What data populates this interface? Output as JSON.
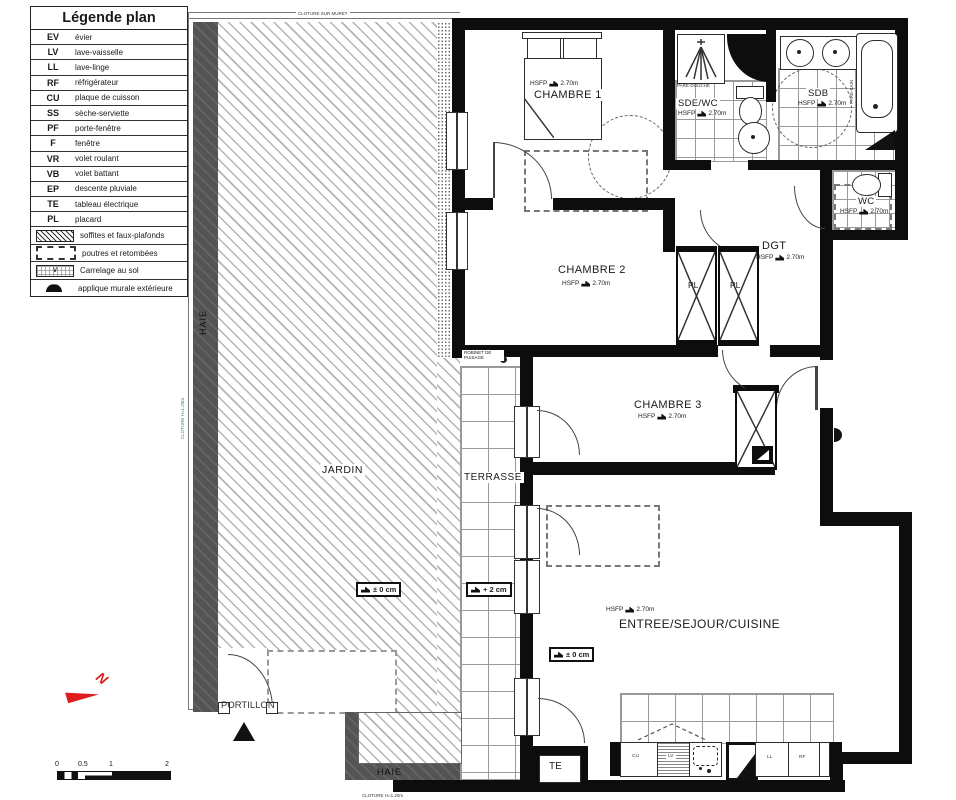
{
  "legend": {
    "title": "Légende plan",
    "items": [
      {
        "abbr": "EV",
        "label": "évier"
      },
      {
        "abbr": "LV",
        "label": "lave-vaisselle"
      },
      {
        "abbr": "LL",
        "label": "lave-linge"
      },
      {
        "abbr": "RF",
        "label": "réfrigérateur"
      },
      {
        "abbr": "CU",
        "label": "plaque de cuisson"
      },
      {
        "abbr": "SS",
        "label": "sèche-serviette"
      },
      {
        "abbr": "PF",
        "label": "porte-fenêtre"
      },
      {
        "abbr": "F",
        "label": "fenêtre"
      },
      {
        "abbr": "VR",
        "label": "volet roulant"
      },
      {
        "abbr": "VB",
        "label": "volet battant"
      },
      {
        "abbr": "EP",
        "label": "descente pluviale"
      },
      {
        "abbr": "TE",
        "label": "tableau électrique"
      },
      {
        "abbr": "PL",
        "label": "placard"
      }
    ],
    "symbols": [
      {
        "label": "soffites et faux-plafonds"
      },
      {
        "label": "poutres et retombées"
      },
      {
        "label": "Carrelage au sol"
      },
      {
        "label": "applique murale extérieure"
      }
    ]
  },
  "site": {
    "cloture_top": "CLOTURE SUR MURET",
    "cloture_left": "CLOTURE H=1.20m",
    "cloture_bottom": "CLOTURE H=1.20m",
    "haie": "HAIE",
    "jardin": "JARDIN",
    "terrasse": "TERRASSE",
    "portillon": "PORTILLON",
    "robinet": "ROBINET DE PUISAGE"
  },
  "rooms": {
    "chambre1": {
      "name": "CHAMBRE 1",
      "hsfp": "HSFP",
      "h": "2.70m"
    },
    "chambre2": {
      "name": "CHAMBRE 2",
      "hsfp": "HSFP",
      "h": "2.70m"
    },
    "chambre3": {
      "name": "CHAMBRE 3",
      "hsfp": "HSFP",
      "h": "2.70m"
    },
    "sdewc": {
      "name": "SDE/WC",
      "hsfp": "HSFP",
      "h": "2.70m"
    },
    "sdb": {
      "name": "SDB",
      "hsfp": "HSFP",
      "h": "2.70m"
    },
    "wc": {
      "name": "WC",
      "hsfp": "HSFP",
      "h": "2.70m"
    },
    "dgt": {
      "name": "DGT",
      "hsfp": "HSFP",
      "h": "2.70m"
    },
    "sejour": {
      "name": "ENTREE/SEJOUR/CUISINE",
      "hsfp": "HSFP",
      "h": "2.70m"
    }
  },
  "pare": {
    "douche": "PARE-DOUCHE",
    "bain": "PARE-BAIN"
  },
  "closets": {
    "pl": "PL"
  },
  "levels": {
    "jardin": "± 0 cm",
    "terrasse": "+ 2 cm",
    "sejour": "± 0 cm"
  },
  "kitchen": {
    "cu": "CU",
    "lv": "LV",
    "ll": "LL",
    "rf": "RF",
    "te": "TE"
  },
  "scalebar": [
    "0",
    "0.5",
    "1",
    "2"
  ],
  "north": "N"
}
